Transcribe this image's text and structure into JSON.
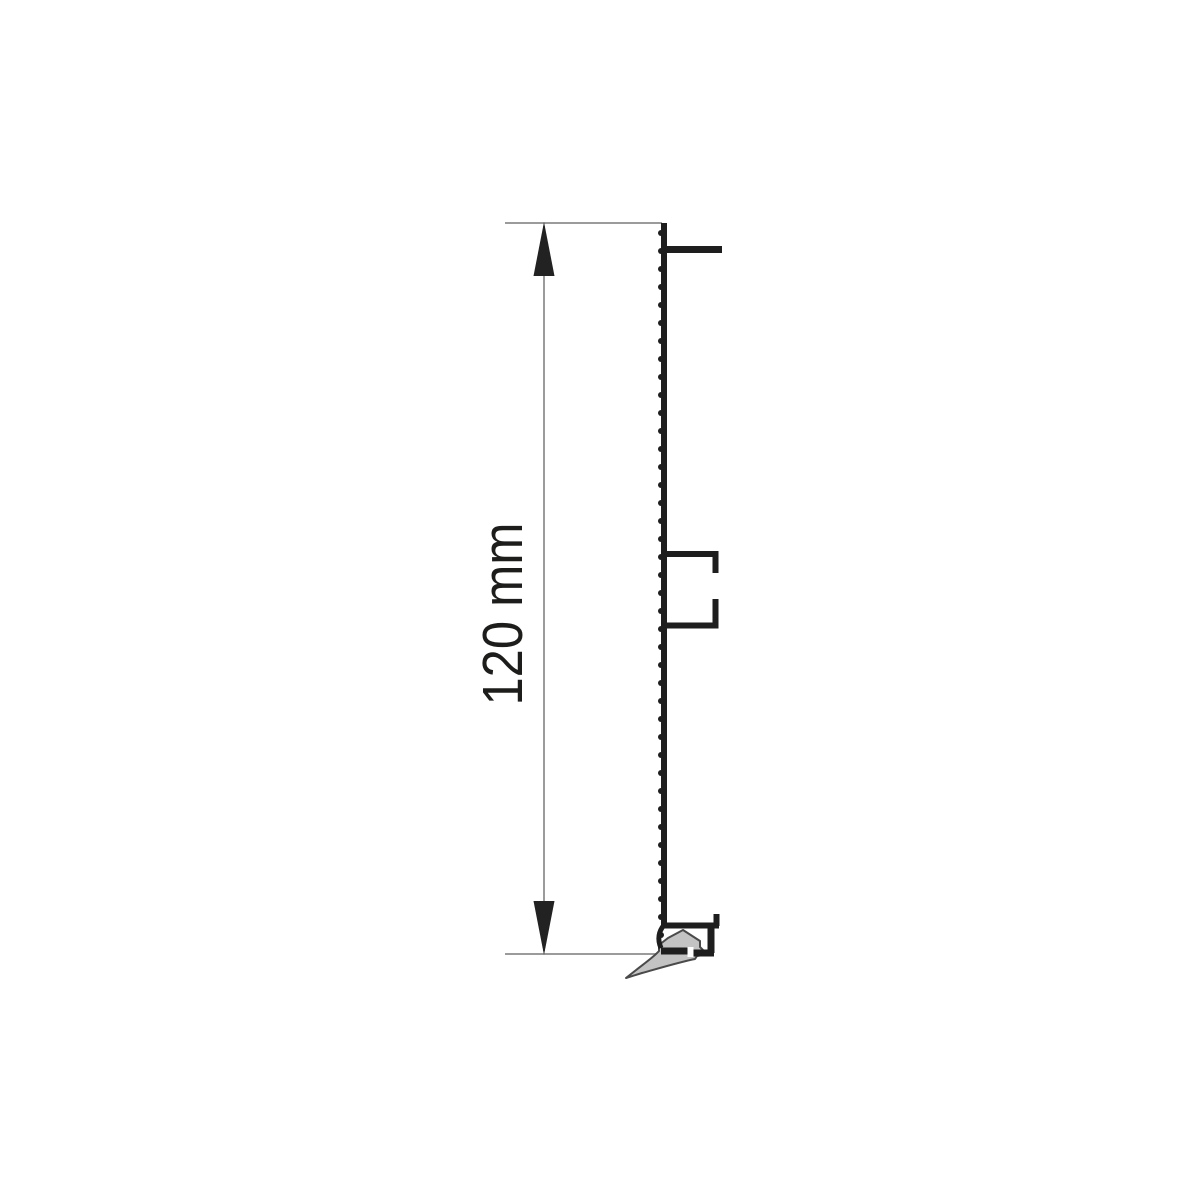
{
  "diagram": {
    "title": "",
    "dimension": {
      "label": "120 mm",
      "value": 120,
      "unit": "mm",
      "orientation": "vertical"
    },
    "parts": {
      "profile_web": "serrated vertical panel web",
      "top_flange": "upper mounting flange",
      "middle_clip": "central clip channel",
      "bottom_rail": "bottom rail with hook",
      "gasket": "bottom sealing lip"
    },
    "colors": {
      "profile": "#1e1e1e",
      "dimension_line": "#9b9b9b",
      "arrow": "#222222",
      "label_text": "#1d1d1b",
      "gasket_fill": "#c3c3c3",
      "gasket_outline": "#4a4a4a",
      "notch": "#ffffff",
      "background": "#ffffff"
    },
    "serration": {
      "start_y": 233,
      "end_y": 941,
      "step": 18,
      "radius": 3,
      "x": 661
    }
  }
}
